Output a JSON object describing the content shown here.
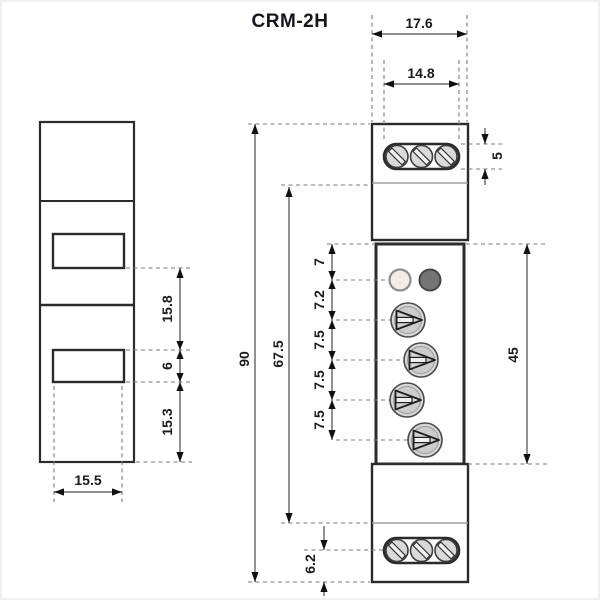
{
  "title": "CRM-2H",
  "side_view": {
    "dim_upper_gap": "15.8",
    "dim_slot_height": "6",
    "dim_lower_gap": "15.3",
    "dim_width": "15.5"
  },
  "front_view": {
    "dim_outer_width": "17.6",
    "dim_terminal_width": "14.8",
    "dim_terminal_height": "5",
    "dim_led_offset": "7",
    "dim_led_knob_gap": "7.2",
    "dim_knob_gap1": "7.5",
    "dim_knob_gap2": "7.5",
    "dim_knob_gap3": "7.5",
    "dim_panel_height": "45",
    "dim_total_height": "90",
    "dim_body_height": "67.5",
    "dim_bottom_terminal_offset": "6.2"
  },
  "colors": {
    "line": "#2b2b2b",
    "dash": "#7a7a7a",
    "knob_fill": "#d6d6d6",
    "screw_fill": "#d9d9d9",
    "led_light": "#f1efe5",
    "led_dark": "#747474"
  }
}
